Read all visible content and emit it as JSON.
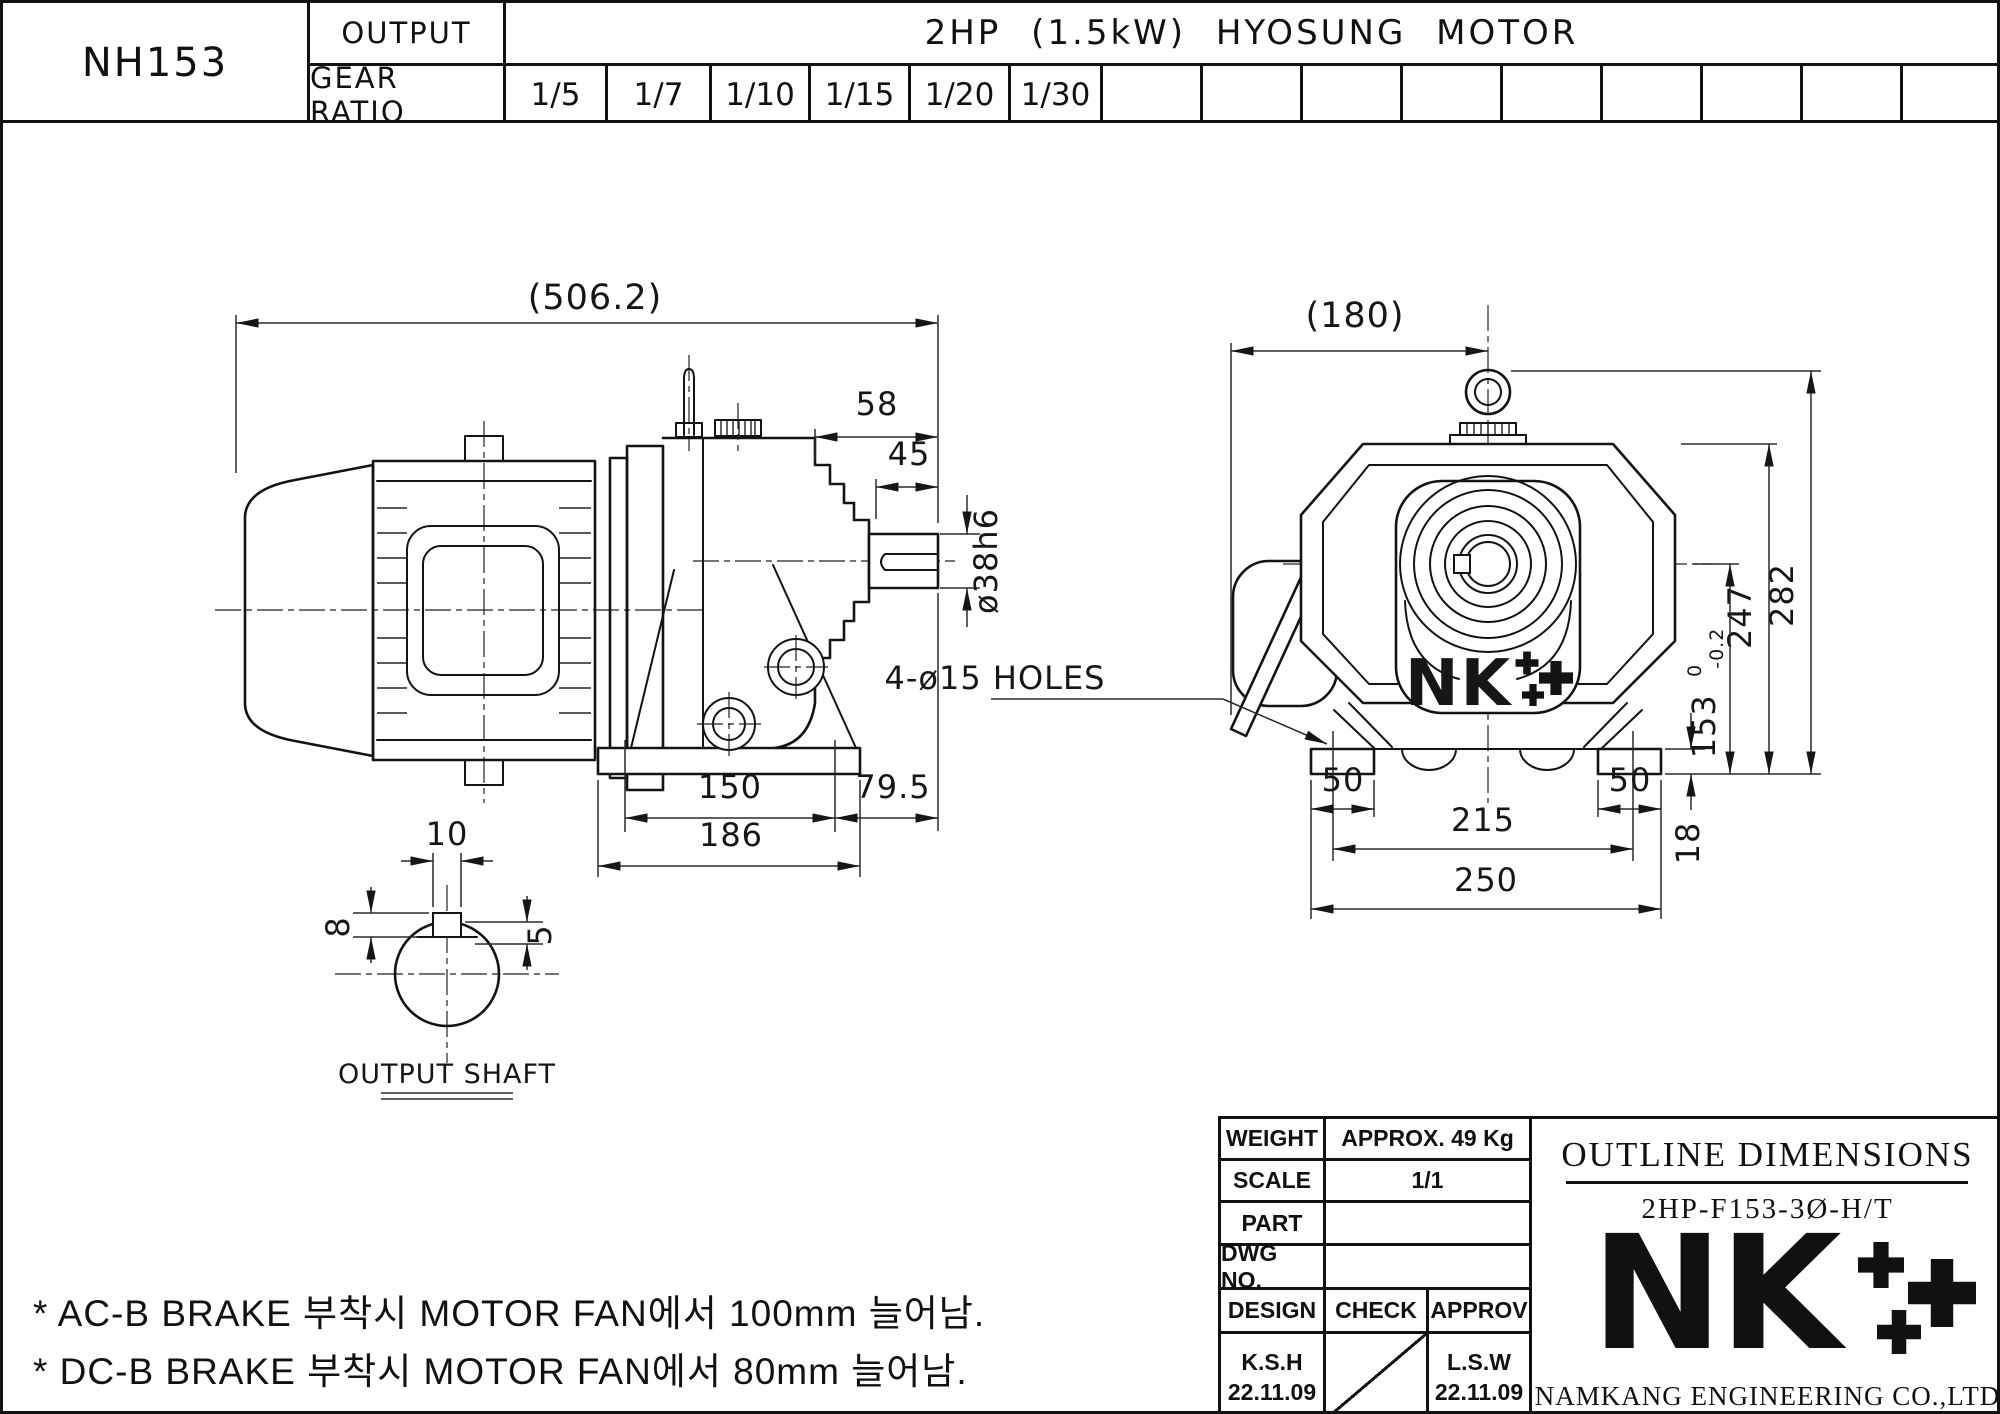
{
  "header": {
    "model": "NH153",
    "output_label": "OUTPUT",
    "gear_ratio_label": "GEAR RATIO",
    "motor_spec": "2HP (1.5kW) HYOSUNG MOTOR",
    "ratios": [
      "1/5",
      "1/7",
      "1/10",
      "1/15",
      "1/20",
      "1/30"
    ]
  },
  "side_view": {
    "dim_overall": "(506.2)",
    "dim_shaft_ext": "58",
    "dim_key_len": "45",
    "dim_shaft_dia": "ø38h6",
    "dim_foot_span": "150",
    "dim_overhang": "79.5",
    "dim_base_len": "186"
  },
  "shaft_detail": {
    "dim_key_width": "10",
    "dim_key_left": "8",
    "dim_key_right": "5",
    "label": "OUTPUT SHAFT"
  },
  "front_view": {
    "dim_width": "(180)",
    "holes_note": "4-ø15 HOLES",
    "dim_total_height": "282",
    "dim_case_height": "247",
    "dim_center_height": "153",
    "tol_upper": "0",
    "tol_lower": "-0.2",
    "dim_base_thickness": "18",
    "dim_foot_left": "50",
    "dim_foot_right": "50",
    "dim_hole_span": "215",
    "dim_base_width": "250",
    "logo": "NK"
  },
  "notes": {
    "line1": "* AC-B BRAKE 부착시 MOTOR FAN에서 100mm 늘어남.",
    "line2": "* DC-B BRAKE 부착시 MOTOR FAN에서 80mm 늘어남."
  },
  "title_block": {
    "weight_label": "WEIGHT",
    "weight_value": "APPROX. 49 Kg",
    "scale_label": "SCALE",
    "scale_value": "1/1",
    "part_label": "PART",
    "part_value": "",
    "dwg_label": "DWG NO.",
    "dwg_value": "",
    "design_label": "DESIGN",
    "check_label": "CHECK",
    "approv_label": "APPROV",
    "design_name": "K.S.H",
    "design_date": "22.11.09",
    "approv_name": "L.S.W",
    "approv_date": "22.11.09",
    "doc_title": "OUTLINE DIMENSIONS",
    "doc_code": "2HP-F153-3Ø-H/T",
    "logo": "NK",
    "company": "NAMKANG ENGINEERING CO.,LTD"
  }
}
